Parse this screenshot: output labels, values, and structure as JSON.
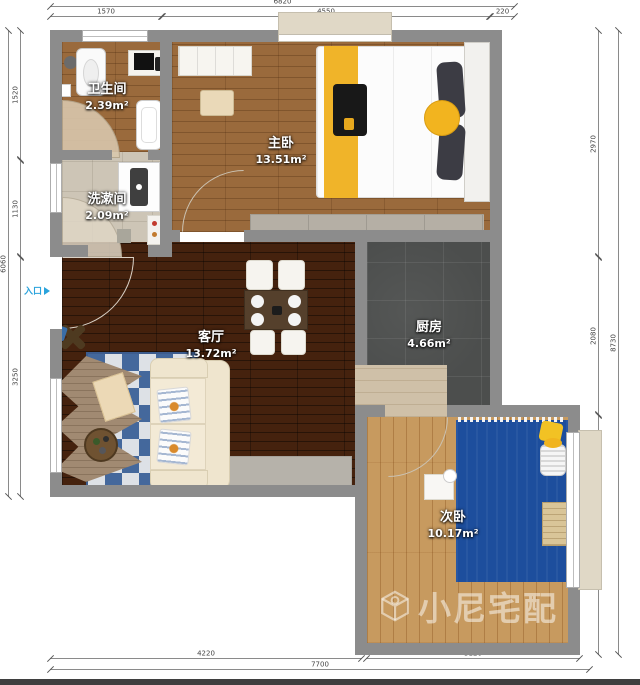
{
  "watermark": {
    "text": "小尼宅配"
  },
  "entrance": {
    "label": "入口"
  },
  "rooms": [
    {
      "name": "卫生间",
      "area": "2.39m²"
    },
    {
      "name": "洗漱间",
      "area": "2.09m²"
    },
    {
      "name": "主卧",
      "area": "13.51m²"
    },
    {
      "name": "厨房",
      "area": "4.66m²"
    },
    {
      "name": "客厅",
      "area": "13.72m²"
    },
    {
      "name": "次卧",
      "area": "10.17m²"
    }
  ],
  "dims": {
    "top_total": "6820",
    "top_left": "1570",
    "top_mid": "4550",
    "top_right": "220",
    "left_top": "1520",
    "left_mid": "1130",
    "left_bottom": "3250",
    "left_total": "6060",
    "right_top": "2970",
    "right_mid": "2080",
    "right_bottom": "3250",
    "right_total": "8730",
    "bottom_left": "4220",
    "bottom_right": "3120",
    "bottom_total": "7700"
  },
  "colors": {
    "wall": "#8c8c8c",
    "entrance_blue": "#2aa3dc",
    "rug_blue": "#1d4e9d",
    "accent_yellow": "#f0b429",
    "kitchen_tile": "#4c4e4d",
    "living_wood": "#45220e"
  }
}
